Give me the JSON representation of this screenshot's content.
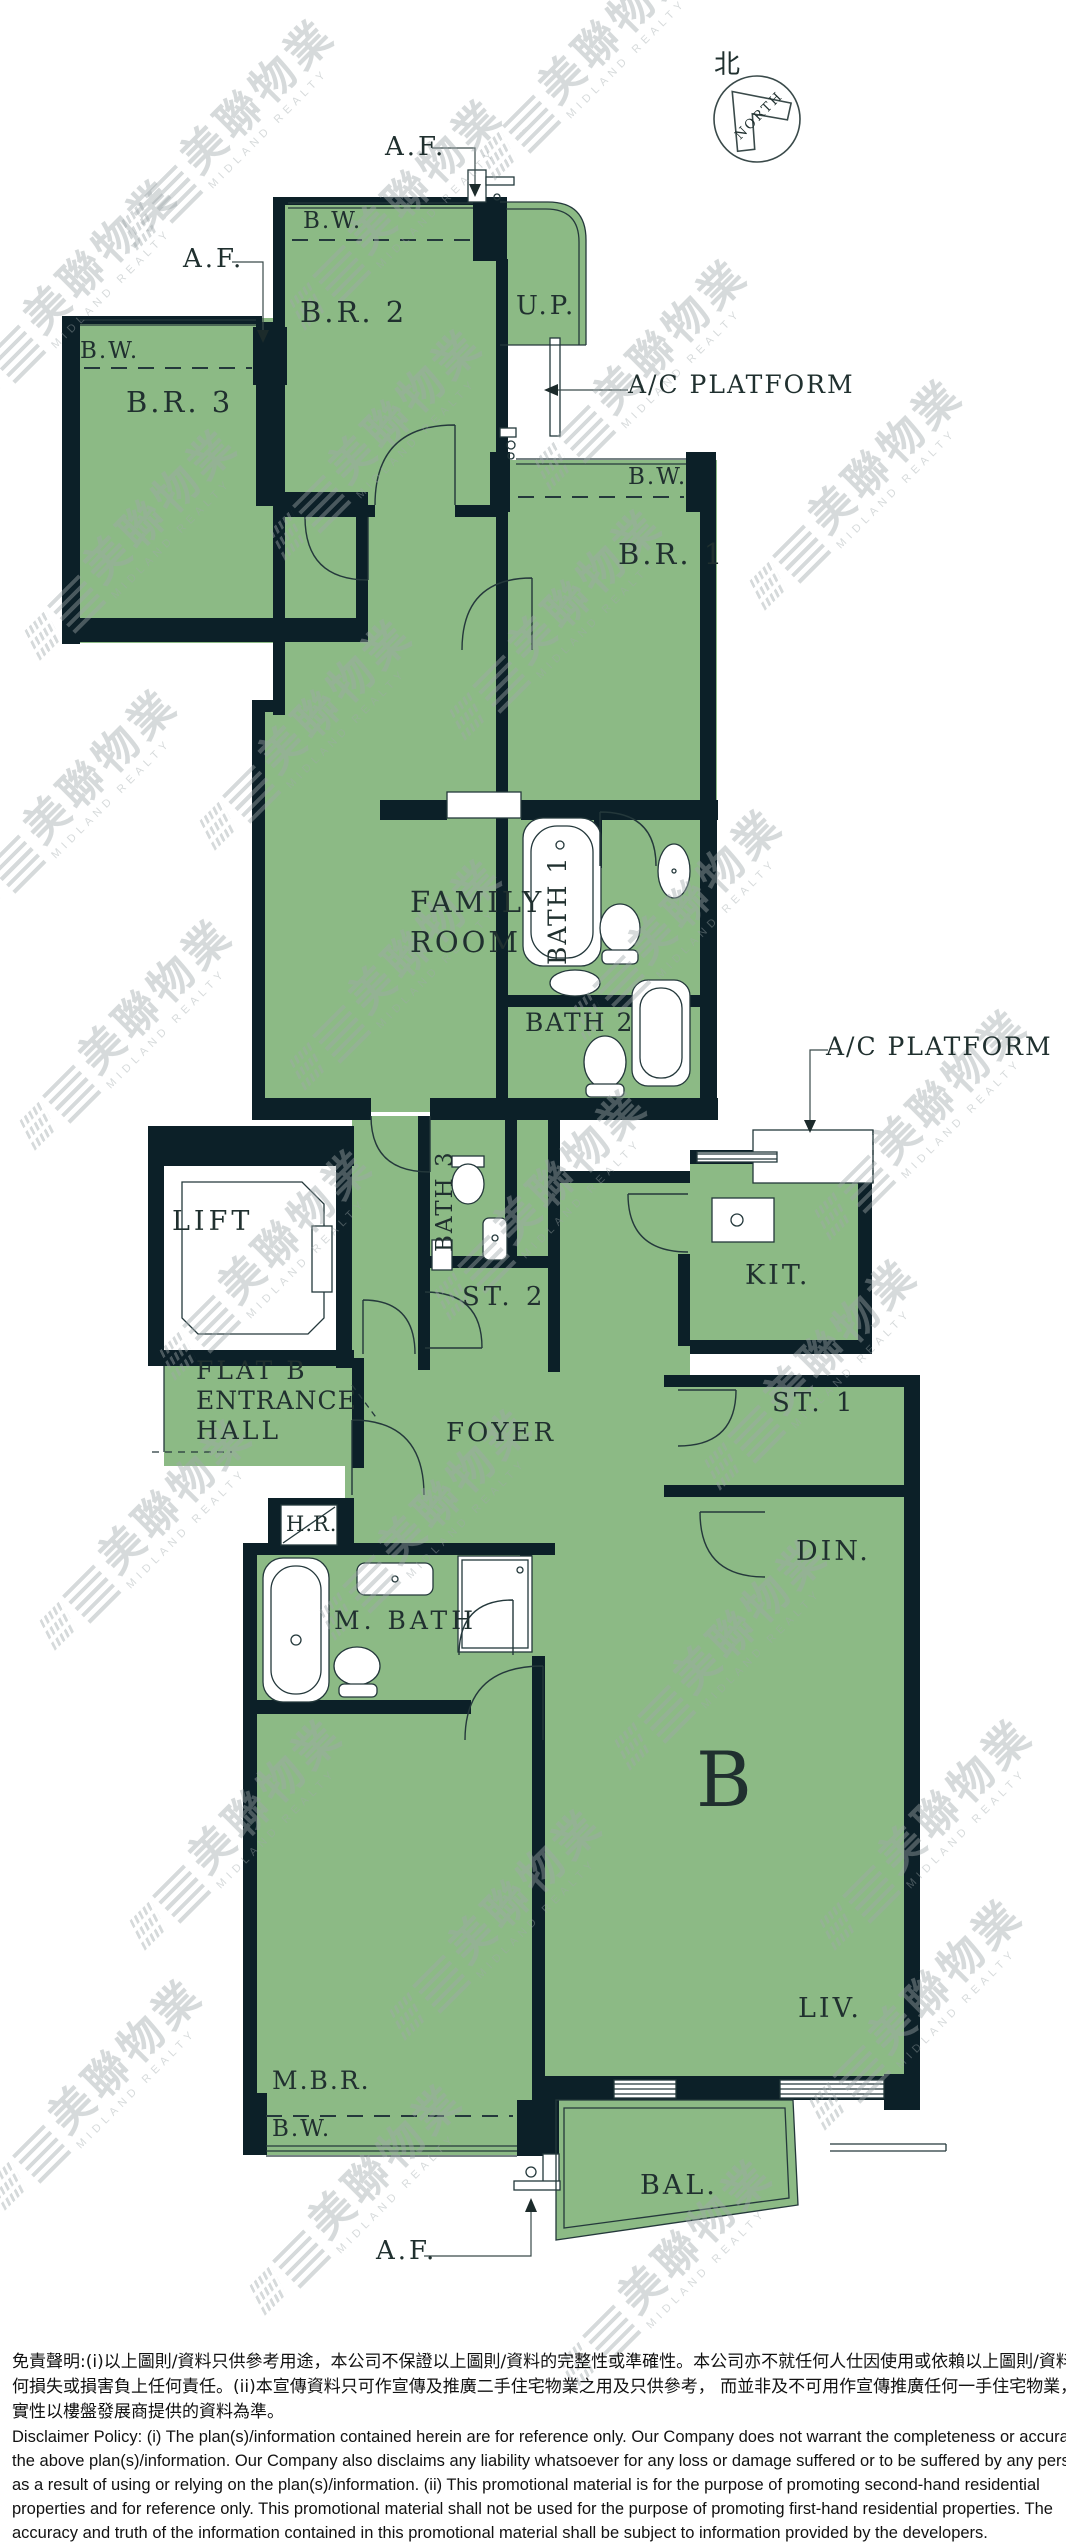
{
  "colors": {
    "room_fill": "#8cba85",
    "wall": "#0c2028",
    "line": "#24383b",
    "text": "#20302f",
    "watermark": "#9fa8aa"
  },
  "watermark": {
    "zh": "美聯物業",
    "en": "MIDLAND REALTY",
    "positions": [
      [
        252,
        160
      ],
      [
        95,
        320
      ],
      [
        420,
        240
      ],
      [
        610,
        90
      ],
      [
        155,
        570
      ],
      [
        400,
        470
      ],
      [
        665,
        400
      ],
      [
        95,
        830
      ],
      [
        330,
        760
      ],
      [
        580,
        650
      ],
      [
        880,
        520
      ],
      [
        150,
        1060
      ],
      [
        420,
        1000
      ],
      [
        700,
        950
      ],
      [
        945,
        1150
      ],
      [
        290,
        1290
      ],
      [
        565,
        1230
      ],
      [
        835,
        1400
      ],
      [
        170,
        1560
      ],
      [
        450,
        1550
      ],
      [
        745,
        1680
      ],
      [
        950,
        1860
      ],
      [
        260,
        1860
      ],
      [
        520,
        1950
      ],
      [
        120,
        2120
      ],
      [
        380,
        2225
      ],
      [
        690,
        2300
      ],
      [
        940,
        2040
      ]
    ]
  },
  "north": {
    "char": "北",
    "word": "NORTH"
  },
  "labels": [
    {
      "id": "north-char",
      "text": "北",
      "x": 714,
      "y": 52,
      "fs": 26,
      "ls": 0
    },
    {
      "id": "north-word",
      "text": "NORTH",
      "x": 733,
      "y": 133,
      "fs": 13,
      "ls": 2,
      "rot": -45
    },
    {
      "id": "af-top",
      "text": "A.F.",
      "x": 385,
      "y": 134,
      "fs": 26,
      "ls": 3
    },
    {
      "id": "bw-br2",
      "text": "B.W.",
      "x": 303,
      "y": 210,
      "fs": 23,
      "ls": 2
    },
    {
      "id": "br2",
      "text": "B.R. 2",
      "x": 300,
      "y": 298,
      "fs": 29,
      "ls": 3
    },
    {
      "id": "up",
      "text": "U.P.",
      "x": 516,
      "y": 293,
      "fs": 26,
      "ls": 3
    },
    {
      "id": "ac-platform-top",
      "text": "A/C PLATFORM",
      "x": 628,
      "y": 372,
      "fs": 25,
      "ls": 2
    },
    {
      "id": "af-left",
      "text": "A.F.",
      "x": 183,
      "y": 246,
      "fs": 26,
      "ls": 3
    },
    {
      "id": "bw-br3",
      "text": "B.W.",
      "x": 80,
      "y": 340,
      "fs": 23,
      "ls": 2
    },
    {
      "id": "br3",
      "text": "B.R. 3",
      "x": 126,
      "y": 388,
      "fs": 29,
      "ls": 3
    },
    {
      "id": "bw-br1",
      "text": "B.W.",
      "x": 628,
      "y": 466,
      "fs": 23,
      "ls": 2
    },
    {
      "id": "br1",
      "text": "B.R. 1",
      "x": 618,
      "y": 540,
      "fs": 29,
      "ls": 3
    },
    {
      "id": "family-line1",
      "text": "FAMILY",
      "x": 410,
      "y": 888,
      "fs": 29,
      "ls": 3
    },
    {
      "id": "family-line2",
      "text": "ROOM",
      "x": 410,
      "y": 928,
      "fs": 29,
      "ls": 3
    },
    {
      "id": "bath1",
      "text": "BATH 1",
      "x": 545,
      "y": 965,
      "fs": 25,
      "ls": 2,
      "rot": -90
    },
    {
      "id": "bath2",
      "text": "BATH 2",
      "x": 525,
      "y": 1010,
      "fs": 25,
      "ls": 2
    },
    {
      "id": "ac-platform-kit",
      "text": "A/C PLATFORM",
      "x": 826,
      "y": 1034,
      "fs": 25,
      "ls": 2
    },
    {
      "id": "kit",
      "text": "KIT.",
      "x": 745,
      "y": 1262,
      "fs": 27,
      "ls": 3
    },
    {
      "id": "bath3",
      "text": "BATH 3",
      "x": 434,
      "y": 1252,
      "fs": 23,
      "ls": 2,
      "rot": -90
    },
    {
      "id": "st2",
      "text": "ST. 2",
      "x": 462,
      "y": 1284,
      "fs": 26,
      "ls": 4
    },
    {
      "id": "lift",
      "text": "LIFT",
      "x": 172,
      "y": 1208,
      "fs": 27,
      "ls": 4
    },
    {
      "id": "flatb-line1",
      "text": "FLAT B",
      "x": 196,
      "y": 1358,
      "fs": 25,
      "ls": 3
    },
    {
      "id": "flatb-line2",
      "text": "ENTRANCE",
      "x": 196,
      "y": 1388,
      "fs": 25,
      "ls": 1
    },
    {
      "id": "flatb-line3",
      "text": "HALL",
      "x": 196,
      "y": 1418,
      "fs": 25,
      "ls": 3
    },
    {
      "id": "foyer",
      "text": "FOYER",
      "x": 446,
      "y": 1420,
      "fs": 26,
      "ls": 3
    },
    {
      "id": "st1",
      "text": "ST. 1",
      "x": 772,
      "y": 1390,
      "fs": 26,
      "ls": 4
    },
    {
      "id": "hr",
      "text": "H.R.",
      "x": 286,
      "y": 1514,
      "fs": 21,
      "ls": 1
    },
    {
      "id": "mbath",
      "text": "M. BATH",
      "x": 334,
      "y": 1608,
      "fs": 25,
      "ls": 4
    },
    {
      "id": "din",
      "text": "DIN.",
      "x": 796,
      "y": 1538,
      "fs": 27,
      "ls": 3
    },
    {
      "id": "flat-letter",
      "text": "B",
      "x": 696,
      "y": 1742,
      "fs": 76,
      "ls": 0
    },
    {
      "id": "liv",
      "text": "LIV.",
      "x": 798,
      "y": 1995,
      "fs": 27,
      "ls": 3
    },
    {
      "id": "mbr",
      "text": "M.B.R.",
      "x": 272,
      "y": 2068,
      "fs": 25,
      "ls": 2
    },
    {
      "id": "bw-mbr",
      "text": "B.W.",
      "x": 272,
      "y": 2118,
      "fs": 23,
      "ls": 2
    },
    {
      "id": "bal",
      "text": "BAL.",
      "x": 640,
      "y": 2172,
      "fs": 27,
      "ls": 3
    },
    {
      "id": "af-bottom",
      "text": "A.F.",
      "x": 376,
      "y": 2238,
      "fs": 26,
      "ls": 3
    }
  ],
  "disclaimer": {
    "zh": [
      "免責聲明:(i)以上圖則/資料只供參考用途，本公司不保證以上圖則/資料的完整性或準確性。本公司亦不就任何人仕因使用或依賴以上圖則/資料所引致之任",
      "何損失或損害負上任何責任。(ii)本宣傳資料只可作宣傳及推廣二手住宅物業之用及只供參考， 而並非及不可用作宣傳推廣任何一手住宅物業，其準確性及真",
      "實性以樓盤發展商提供的資料為準。"
    ],
    "en": [
      "Disclaimer Policy: (i) The plan(s)/information contained herein are for reference only. Our Company does not warrant the completeness or accuracy of",
      "the above plan(s)/information. Our Company also disclaims any liability whatsoever for any loss or damage suffered or to be suffered by any person",
      "as a result of using or relying on the plan(s)/information. (ii) This promotional material is for the purpose of promoting second-hand residential",
      "properties and for reference only. This promotional material shall not be used for the purpose of promoting first-hand residential properties. The",
      "accuracy and truth of the information contained in this promotional material shall be subject to information provided by the developers."
    ]
  }
}
